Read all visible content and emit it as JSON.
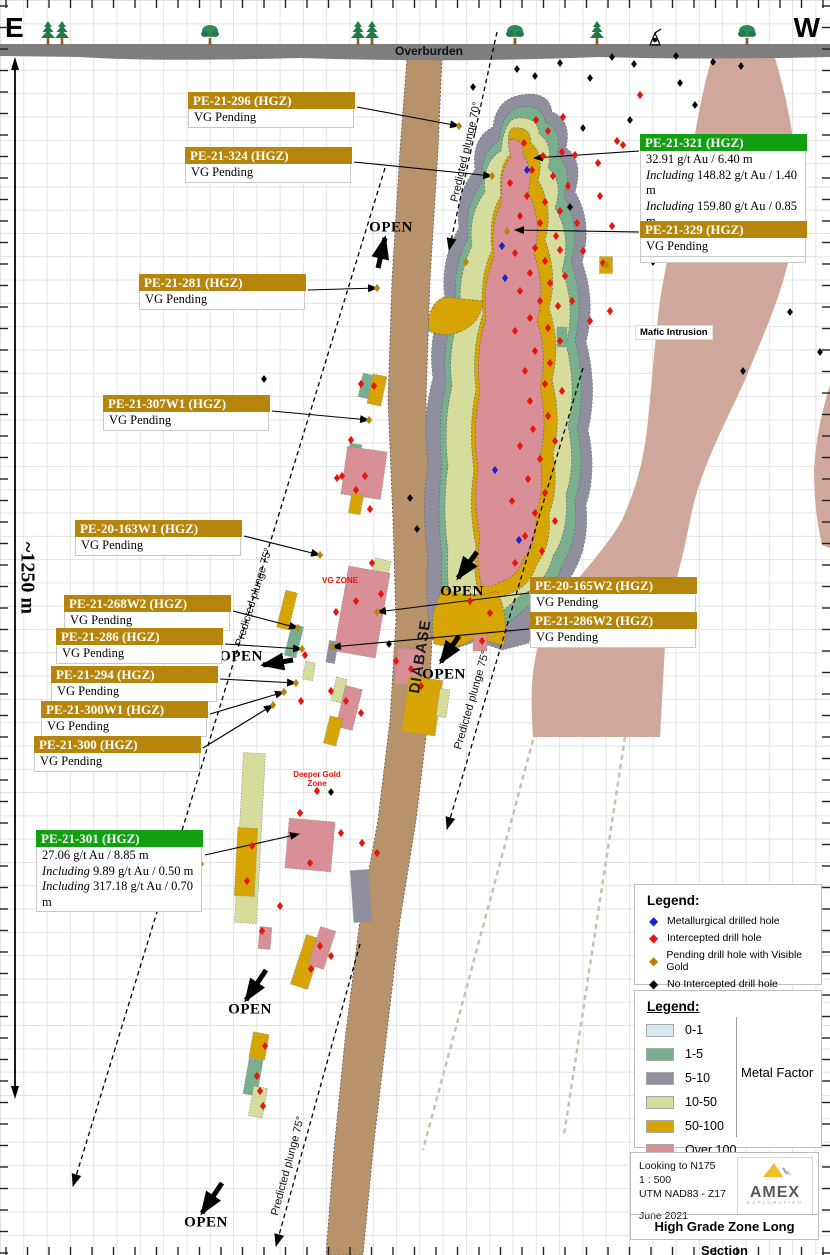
{
  "compass": {
    "east": "E",
    "west": "W"
  },
  "surface": {
    "overburden_label": "Overburden"
  },
  "geology": {
    "diabase_label": "DIABASE",
    "mafic_label": "Mafic Intrusion",
    "vg_zone_label": "VG ZONE",
    "deeper_gold_zone_label": "Deeper Gold Zone"
  },
  "scale": {
    "label": "~1250 m"
  },
  "colors": {
    "label_gold": "#b5860b",
    "label_green": "#12a012",
    "mf_0_1": "#d6eaf5",
    "mf_1_5": "#79ae8e",
    "mf_5_10": "#8f8fa0",
    "mf_10_50": "#d6dc9c",
    "mf_50_100": "#d6a504",
    "mf_over_100": "#d98f96",
    "diabase": "#b7926b",
    "mafic": "#cfa79b",
    "overburden": "#7e7e7e",
    "marker_red": "#e8150c",
    "marker_blue": "#1822cc",
    "marker_gold": "#b5860b",
    "marker_black": "#000000"
  },
  "annotations": [
    {
      "id": "PE-21-296",
      "style": "gold",
      "title": "PE-21-296 (HGZ)",
      "box": [
        188,
        92
      ],
      "lines": [
        {
          "text": "VG Pending"
        }
      ],
      "arrow": [
        357,
        107,
        459,
        126
      ]
    },
    {
      "id": "PE-21-324",
      "style": "gold",
      "title": "PE-21-324 (HGZ)",
      "box": [
        185,
        147
      ],
      "lines": [
        {
          "text": "VG Pending"
        }
      ],
      "arrow": [
        354,
        162,
        492,
        176
      ]
    },
    {
      "id": "PE-21-281",
      "style": "gold",
      "title": "PE-21-281 (HGZ)",
      "box": [
        139,
        274
      ],
      "lines": [
        {
          "text": "VG Pending"
        }
      ],
      "arrow": [
        308,
        290,
        377,
        288
      ]
    },
    {
      "id": "PE-21-307W1",
      "style": "gold",
      "title": "PE-21-307W1 (HGZ)",
      "box": [
        103,
        395
      ],
      "lines": [
        {
          "text": "VG Pending"
        }
      ],
      "arrow": [
        272,
        411,
        369,
        420
      ]
    },
    {
      "id": "PE-20-163W1",
      "style": "gold",
      "title": "PE-20-163W1 (HGZ)",
      "box": [
        75,
        520
      ],
      "lines": [
        {
          "text": "VG Pending"
        }
      ],
      "arrow": [
        244,
        536,
        320,
        555
      ]
    },
    {
      "id": "PE-21-268W2",
      "style": "gold",
      "title": "PE-21-268W2 (HGZ)",
      "box": [
        64,
        595
      ],
      "lines": [
        {
          "text": "VG Pending"
        }
      ],
      "arrow": [
        233,
        611,
        298,
        628
      ]
    },
    {
      "id": "PE-21-286",
      "style": "gold",
      "title": "PE-21-286 (HGZ)",
      "box": [
        56,
        628
      ],
      "lines": [
        {
          "text": "VG Pending"
        }
      ],
      "arrow": [
        225,
        644,
        302,
        649
      ]
    },
    {
      "id": "PE-21-294",
      "style": "gold",
      "title": "PE-21-294 (HGZ)",
      "box": [
        51,
        666
      ],
      "lines": [
        {
          "text": "VG Pending"
        }
      ],
      "arrow": [
        220,
        679,
        296,
        683
      ]
    },
    {
      "id": "PE-21-300W1",
      "style": "gold",
      "title": "PE-21-300W1 (HGZ)",
      "box": [
        41,
        701
      ],
      "lines": [
        {
          "text": "VG Pending"
        }
      ],
      "arrow": [
        210,
        714,
        284,
        692
      ]
    },
    {
      "id": "PE-21-300",
      "style": "gold",
      "title": "PE-21-300 (HGZ)",
      "box": [
        34,
        736
      ],
      "lines": [
        {
          "text": "VG Pending"
        }
      ],
      "arrow": [
        203,
        748,
        273,
        705
      ]
    },
    {
      "id": "PE-21-301",
      "style": "green",
      "title": "PE-21-301 (HGZ)",
      "box": [
        36,
        830
      ],
      "lines": [
        {
          "text": "27.06 g/t Au / 8.85 m"
        },
        {
          "pre": "Including",
          "text": "9.89 g/t Au / 0.50 m"
        },
        {
          "pre": "Including",
          "text": "317.18 g/t Au / 0.70 m"
        }
      ],
      "arrow": [
        205,
        855,
        299,
        834
      ]
    },
    {
      "id": "PE-21-321",
      "style": "green",
      "title": "PE-21-321 (HGZ)",
      "box": [
        640,
        134
      ],
      "lines": [
        {
          "text": "32.91 g/t Au / 6.40 m"
        },
        {
          "pre": "Including",
          "text": "148.82 g/t Au / 1.40 m"
        },
        {
          "pre": "Including",
          "text": "159.80 g/t Au / 0.85 m"
        },
        {
          "pre": "Including",
          "text": "131.86 g/t Au / 0.55 m"
        }
      ],
      "arrow": [
        639,
        151,
        534,
        158
      ]
    },
    {
      "id": "PE-21-329",
      "style": "gold",
      "title": "PE-21-329 (HGZ)",
      "box": [
        640,
        221
      ],
      "lines": [
        {
          "text": "VG Pending"
        }
      ],
      "arrow": [
        639,
        232,
        515,
        230
      ]
    },
    {
      "id": "PE-20-165W2",
      "style": "gold",
      "title": "PE-20-165W2 (HGZ)",
      "box": [
        530,
        577
      ],
      "lines": [
        {
          "text": "VG Pending"
        }
      ],
      "arrow": [
        529,
        593,
        377,
        612
      ]
    },
    {
      "id": "PE-21-286W2",
      "style": "gold",
      "title": "PE-21-286W2 (HGZ)",
      "box": [
        530,
        612
      ],
      "lines": [
        {
          "text": "VG Pending"
        }
      ],
      "arrow": [
        529,
        629,
        332,
        647
      ]
    }
  ],
  "open_labels": [
    {
      "text": "OPEN",
      "x": 391,
      "y": 228,
      "arrow": [
        378,
        268,
        385,
        238
      ]
    },
    {
      "text": "OPEN",
      "x": 462,
      "y": 592,
      "arrow": [
        477,
        552,
        458,
        578
      ]
    },
    {
      "text": "OPEN",
      "x": 241,
      "y": 657,
      "arrow": [
        293,
        660,
        263,
        665
      ]
    },
    {
      "text": "OPEN",
      "x": 444,
      "y": 675,
      "arrow": [
        459,
        636,
        441,
        662
      ]
    },
    {
      "text": "OPEN",
      "x": 250,
      "y": 1010,
      "arrow": [
        266,
        970,
        246,
        1000
      ]
    },
    {
      "text": "OPEN",
      "x": 206,
      "y": 1223,
      "arrow": [
        222,
        1183,
        202,
        1213
      ]
    }
  ],
  "plunge_lines": [
    {
      "label": "Predicted plunge 70°",
      "line": [
        497,
        32,
        449,
        250
      ],
      "label_pos": [
        466,
        152
      ],
      "angle": -77
    },
    {
      "label": "Predicted plunge 75°",
      "line": [
        385,
        168,
        73,
        1186
      ],
      "label_pos": [
        254,
        597
      ],
      "angle": -73
    },
    {
      "label": "Predicted plunge 75°",
      "line": [
        583,
        368,
        447,
        829
      ],
      "label_pos": [
        472,
        700
      ],
      "angle": -74
    },
    {
      "label": "Predicted plunge 75°",
      "line": [
        360,
        944,
        276,
        1246
      ],
      "label_pos": [
        288,
        1166
      ],
      "angle": -75
    }
  ],
  "legend_holes": {
    "title": "Legend:",
    "items": [
      {
        "label": "Metallurgical drilled hole",
        "color": "#1822cc"
      },
      {
        "label": "Intercepted drill hole",
        "color": "#e8150c"
      },
      {
        "label": "Pending drill hole with Visible Gold",
        "color": "#b5860b"
      },
      {
        "label": "No Intercepted drill hole",
        "color": "#000000"
      }
    ]
  },
  "legend_mf": {
    "title": "Legend:",
    "caption": "Metal Factor",
    "items": [
      {
        "label": "0-1",
        "color": "#d6eaf5"
      },
      {
        "label": "1-5",
        "color": "#79ae8e"
      },
      {
        "label": "5-10",
        "color": "#8f8fa0"
      },
      {
        "label": "10-50",
        "color": "#d6dc9c"
      },
      {
        "label": "50-100",
        "color": "#d6a504"
      },
      {
        "label": "Over 100",
        "color": "#d98f96"
      }
    ]
  },
  "footer": {
    "line1": "Looking to N175",
    "line2": "1 : 500",
    "line3": "UTM NAD83 - Z17",
    "date": "June 2021",
    "logo_name": "AMEX",
    "logo_sub": "EXPLORATION",
    "title": "High Grade Zone Long Section"
  },
  "markers": {
    "gold": [
      [
        459,
        126
      ],
      [
        492,
        176
      ],
      [
        466,
        262
      ],
      [
        507,
        231
      ],
      [
        377,
        288
      ],
      [
        369,
        420
      ],
      [
        320,
        555
      ],
      [
        377,
        612
      ],
      [
        298,
        628
      ],
      [
        302,
        649
      ],
      [
        332,
        647
      ],
      [
        296,
        683
      ],
      [
        284,
        692
      ],
      [
        273,
        705
      ],
      [
        201,
        864
      ],
      [
        606,
        265
      ]
    ],
    "blue": [
      [
        527,
        170
      ],
      [
        502,
        246
      ],
      [
        505,
        278
      ],
      [
        495,
        470
      ],
      [
        519,
        540
      ]
    ],
    "black": [
      [
        473,
        87
      ],
      [
        517,
        69
      ],
      [
        535,
        76
      ],
      [
        560,
        63
      ],
      [
        590,
        78
      ],
      [
        612,
        57
      ],
      [
        634,
        64
      ],
      [
        676,
        56
      ],
      [
        680,
        83
      ],
      [
        695,
        105
      ],
      [
        713,
        62
      ],
      [
        741,
        66
      ],
      [
        583,
        128
      ],
      [
        630,
        120
      ],
      [
        570,
        207
      ],
      [
        772,
        185
      ],
      [
        653,
        262
      ],
      [
        743,
        371
      ],
      [
        790,
        312
      ],
      [
        820,
        352
      ],
      [
        410,
        498
      ],
      [
        417,
        529
      ],
      [
        389,
        644
      ],
      [
        331,
        792
      ],
      [
        264,
        379
      ]
    ],
    "red": [
      [
        536,
        120
      ],
      [
        524,
        143
      ],
      [
        548,
        131
      ],
      [
        543,
        156
      ],
      [
        562,
        152
      ],
      [
        532,
        170
      ],
      [
        553,
        176
      ],
      [
        568,
        186
      ],
      [
        510,
        183
      ],
      [
        527,
        196
      ],
      [
        545,
        202
      ],
      [
        560,
        211
      ],
      [
        520,
        216
      ],
      [
        540,
        223
      ],
      [
        556,
        236
      ],
      [
        535,
        248
      ],
      [
        515,
        253
      ],
      [
        545,
        261
      ],
      [
        565,
        276
      ],
      [
        530,
        273
      ],
      [
        550,
        283
      ],
      [
        520,
        291
      ],
      [
        540,
        301
      ],
      [
        558,
        306
      ],
      [
        530,
        318
      ],
      [
        548,
        328
      ],
      [
        560,
        341
      ],
      [
        515,
        331
      ],
      [
        535,
        351
      ],
      [
        550,
        363
      ],
      [
        525,
        371
      ],
      [
        545,
        384
      ],
      [
        562,
        391
      ],
      [
        530,
        401
      ],
      [
        548,
        416
      ],
      [
        533,
        429
      ],
      [
        555,
        441
      ],
      [
        520,
        446
      ],
      [
        540,
        459
      ],
      [
        528,
        479
      ],
      [
        545,
        493
      ],
      [
        512,
        501
      ],
      [
        535,
        513
      ],
      [
        555,
        521
      ],
      [
        525,
        536
      ],
      [
        542,
        551
      ],
      [
        515,
        563
      ],
      [
        470,
        601
      ],
      [
        490,
        613
      ],
      [
        482,
        641
      ],
      [
        575,
        155
      ],
      [
        598,
        163
      ],
      [
        617,
        141
      ],
      [
        600,
        196
      ],
      [
        577,
        223
      ],
      [
        612,
        226
      ],
      [
        583,
        251
      ],
      [
        603,
        263
      ],
      [
        572,
        301
      ],
      [
        590,
        321
      ],
      [
        610,
        311
      ],
      [
        560,
        250
      ],
      [
        640,
        95
      ],
      [
        623,
        145
      ],
      [
        563,
        117
      ],
      [
        361,
        384
      ],
      [
        374,
        386
      ],
      [
        351,
        440
      ],
      [
        342,
        476
      ],
      [
        365,
        476
      ],
      [
        337,
        478
      ],
      [
        356,
        490
      ],
      [
        370,
        509
      ],
      [
        372,
        563
      ],
      [
        381,
        594
      ],
      [
        356,
        601
      ],
      [
        336,
        612
      ],
      [
        305,
        655
      ],
      [
        331,
        691
      ],
      [
        346,
        701
      ],
      [
        361,
        713
      ],
      [
        396,
        661
      ],
      [
        411,
        669
      ],
      [
        421,
        686
      ],
      [
        301,
        701
      ],
      [
        317,
        791
      ],
      [
        300,
        813
      ],
      [
        341,
        833
      ],
      [
        362,
        843
      ],
      [
        377,
        853
      ],
      [
        310,
        863
      ],
      [
        252,
        846
      ],
      [
        247,
        881
      ],
      [
        280,
        906
      ],
      [
        262,
        931
      ],
      [
        320,
        946
      ],
      [
        331,
        956
      ],
      [
        311,
        969
      ],
      [
        265,
        1046
      ],
      [
        257,
        1076
      ],
      [
        260,
        1091
      ],
      [
        263,
        1106
      ]
    ]
  },
  "intercepts": [
    [
      562,
      337,
      10,
      20,
      0,
      "mf_1_5"
    ],
    [
      606,
      265,
      13,
      17,
      0,
      "mf_50_100"
    ],
    [
      366,
      386,
      11,
      24,
      12,
      "mf_1_5"
    ],
    [
      377,
      390,
      14,
      30,
      12,
      "mf_50_100"
    ],
    [
      355,
      451,
      12,
      14,
      8,
      "mf_1_5"
    ],
    [
      364,
      473,
      40,
      48,
      8,
      "mf_over_100"
    ],
    [
      356,
      504,
      12,
      20,
      10,
      "mf_50_100"
    ],
    [
      377,
      585,
      16,
      52,
      14,
      "mf_10_50"
    ],
    [
      362,
      612,
      42,
      86,
      10,
      "mf_over_100"
    ],
    [
      287,
      610,
      12,
      38,
      14,
      "mf_50_100"
    ],
    [
      294,
      641,
      12,
      32,
      14,
      "mf_1_5"
    ],
    [
      332,
      652,
      9,
      22,
      10,
      "mf_5_10"
    ],
    [
      309,
      671,
      10,
      18,
      10,
      "mf_10_50"
    ],
    [
      339,
      690,
      11,
      24,
      14,
      "mf_10_50"
    ],
    [
      349,
      708,
      17,
      42,
      14,
      "mf_over_100"
    ],
    [
      333,
      731,
      13,
      28,
      14,
      "mf_50_100"
    ],
    [
      409,
      667,
      26,
      36,
      6,
      "mf_over_100"
    ],
    [
      422,
      706,
      34,
      56,
      8,
      "mf_50_100"
    ],
    [
      443,
      703,
      10,
      28,
      8,
      "mf_10_50"
    ],
    [
      480,
      643,
      14,
      16,
      0,
      "mf_over_100"
    ],
    [
      250,
      838,
      22,
      170,
      3,
      "mf_10_50"
    ],
    [
      246,
      862,
      20,
      68,
      3,
      "mf_50_100"
    ],
    [
      310,
      845,
      46,
      50,
      5,
      "mf_over_100"
    ],
    [
      361,
      896,
      18,
      52,
      -4,
      "mf_5_10"
    ],
    [
      265,
      938,
      12,
      22,
      5,
      "mf_over_100"
    ],
    [
      307,
      962,
      18,
      52,
      18,
      "mf_50_100"
    ],
    [
      322,
      948,
      16,
      40,
      18,
      "mf_over_100"
    ],
    [
      259,
      1046,
      16,
      26,
      10,
      "mf_50_100"
    ],
    [
      253,
      1077,
      14,
      36,
      10,
      "mf_1_5"
    ],
    [
      258,
      1102,
      14,
      30,
      10,
      "mf_10_50"
    ]
  ],
  "trees": [
    [
      48,
      "c"
    ],
    [
      62,
      "c"
    ],
    [
      210,
      "d"
    ],
    [
      358,
      "c"
    ],
    [
      372,
      "c"
    ],
    [
      515,
      "d"
    ],
    [
      597,
      "c"
    ],
    [
      747,
      "d"
    ]
  ]
}
